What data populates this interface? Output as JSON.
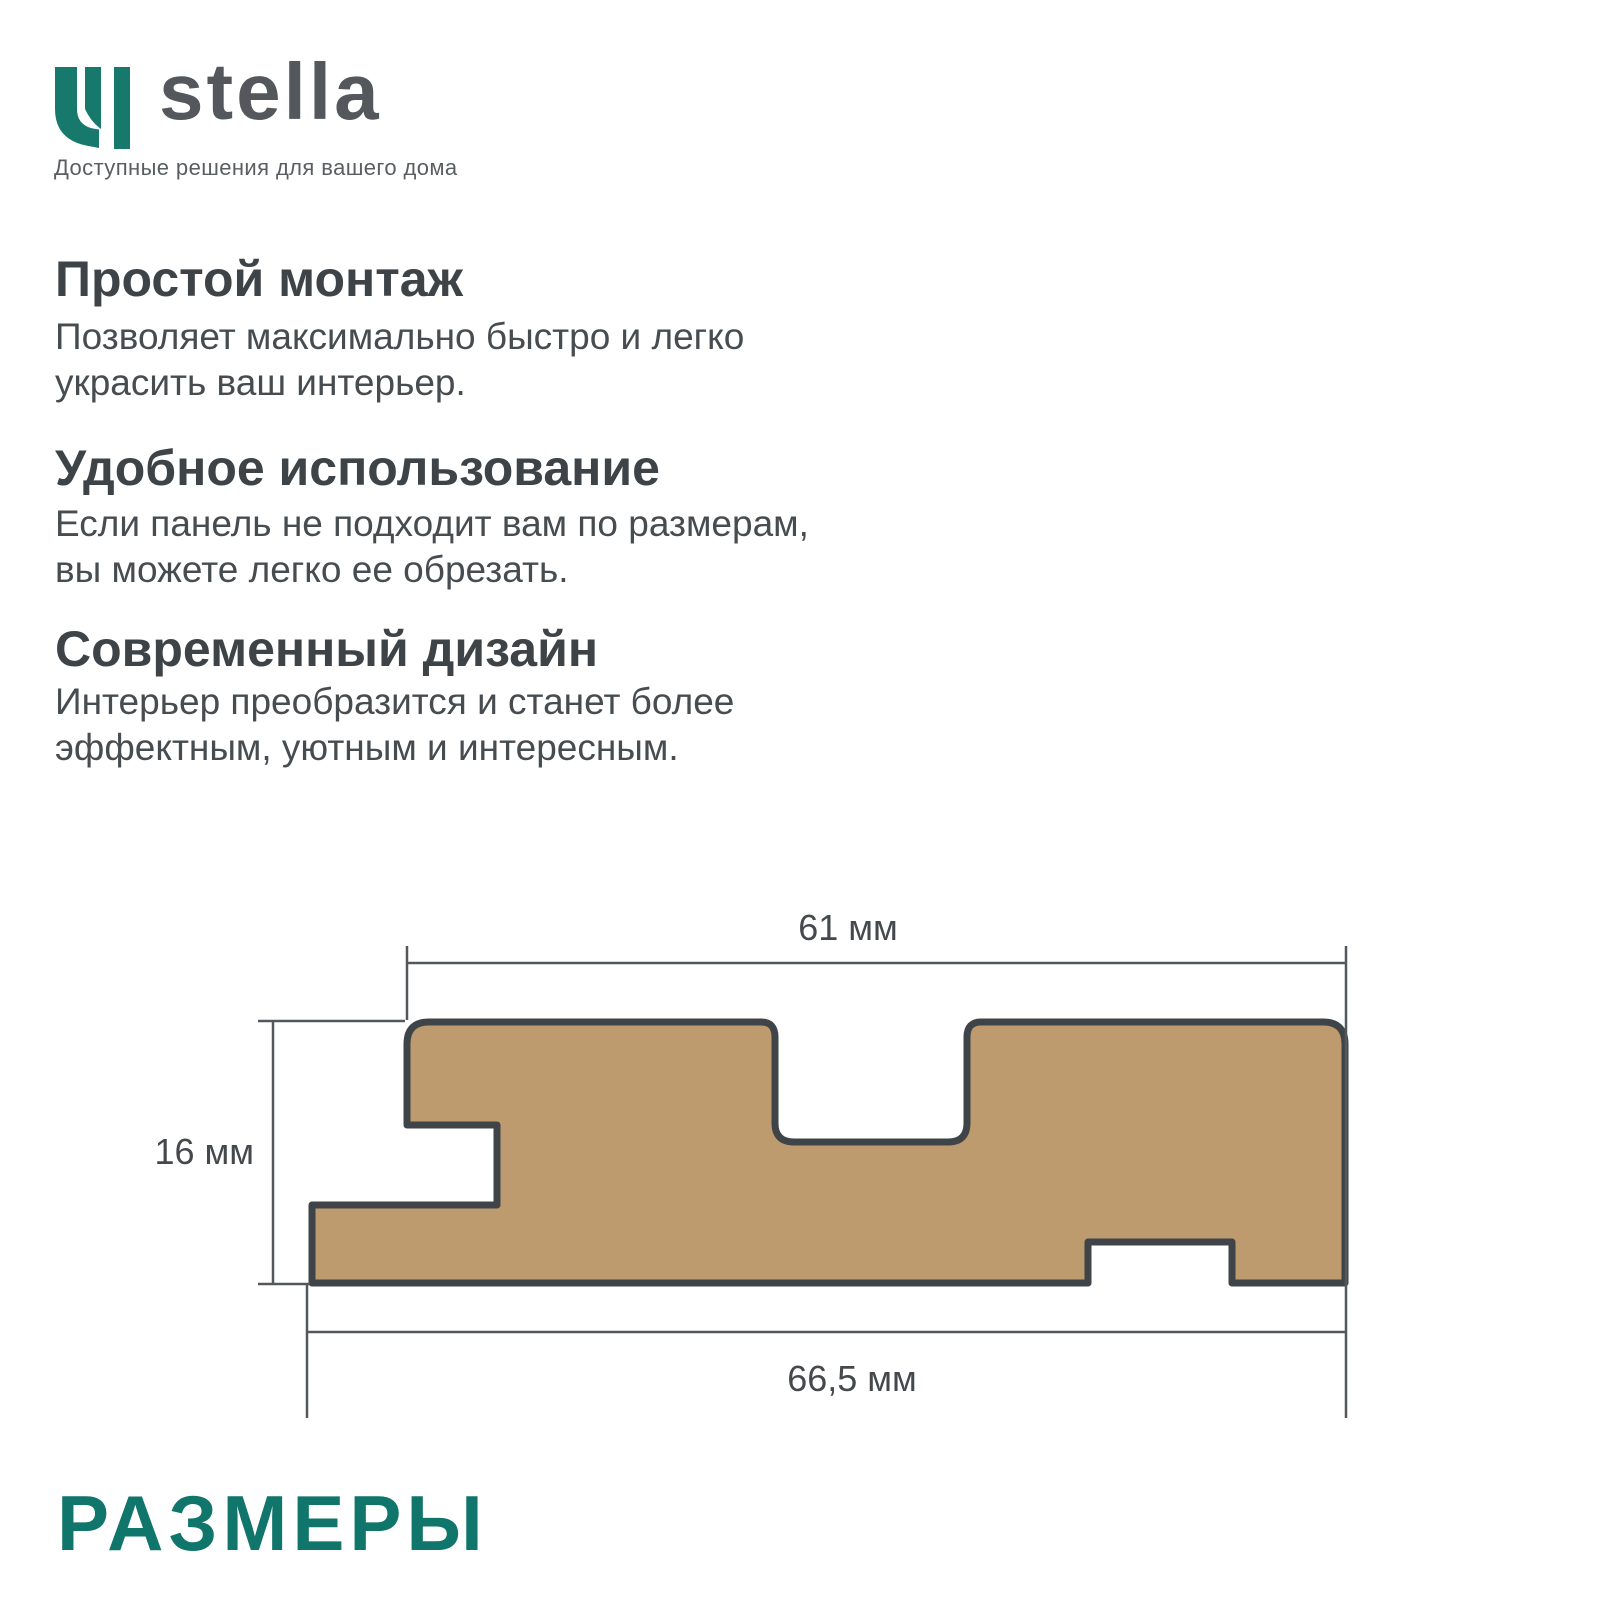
{
  "brand": {
    "name": "stella",
    "tagline": "Доступные решения для вашего дома",
    "logo_color": "#17796b",
    "wordmark_color": "#54585c"
  },
  "features": [
    {
      "title": "Простой монтаж",
      "body": "Позволяет максимально быстро и легко\nукрасить ваш интерьер."
    },
    {
      "title": "Удобное использование",
      "body": "Если панель не подходит вам по размерам,\nвы можете легко ее обрезать."
    },
    {
      "title": "Современный дизайн",
      "body": "Интерьер преобразится и станет более\nэффектным, уютным и интересным."
    }
  ],
  "diagram": {
    "description": "panel cross-section with dimensions",
    "panel_fill": "#bd9b6e",
    "panel_outline": "#3f4449",
    "dim_line_color": "#55585b",
    "dimensions": {
      "top_width": "61 мм",
      "height": "16 мм",
      "bottom_width": "66,5 мм"
    }
  },
  "section_title": {
    "label": "РАЗМЕРЫ",
    "color": "#10756a"
  }
}
